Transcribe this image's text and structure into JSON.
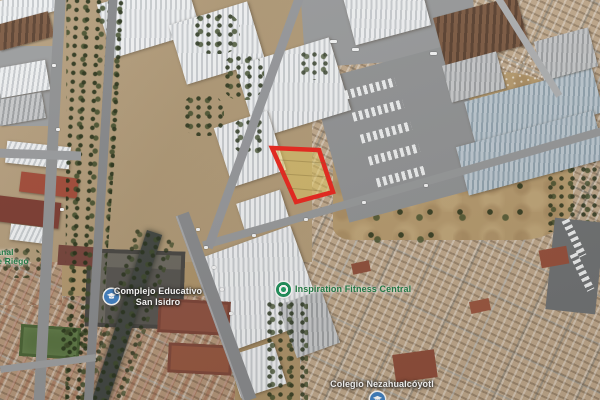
{
  "app": {
    "type": "satellite-map-view"
  },
  "labels": {
    "complejo": {
      "line1": "Complejo Educativo",
      "line2": "San Isidro"
    },
    "fitness": {
      "text": "Inspiration Fitness Central"
    },
    "colegio": {
      "text": "Colegio Nezahualcóyotl"
    },
    "canal": {
      "line1": "Canal",
      "line2": "de Riego"
    }
  },
  "parcel": {
    "outline_color": "#e8251c",
    "fill_color": "rgba(231,206,96,0.5)"
  },
  "colors": {
    "label_white": "#ffffff",
    "label_green": "#1e7a43",
    "poi_blue": "#3f7fc1",
    "poi_green": "#1f9e64",
    "terrain_tan": "#b29470",
    "tree_green": "#3a482a",
    "road_gray": "#96989a"
  }
}
